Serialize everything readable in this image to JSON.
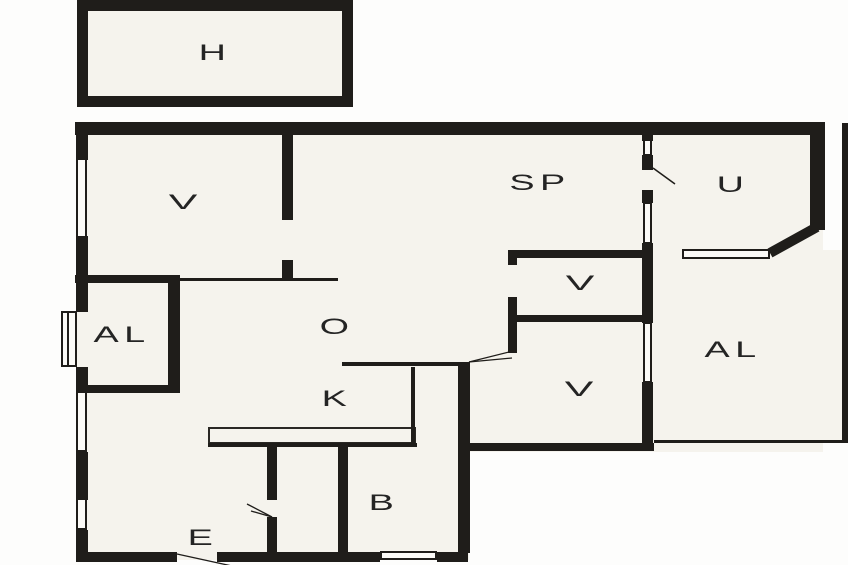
{
  "plan": {
    "width": 848,
    "height": 565,
    "colors": {
      "wall": "#1f1d1a",
      "interior": "#f5f3ed",
      "background": "#fdfdfc",
      "label": "#242424"
    },
    "rooms": [
      {
        "id": "garage",
        "label": "H",
        "x": 215,
        "y": 54,
        "wide": false
      },
      {
        "id": "bedroom-nw",
        "label": "V",
        "x": 183,
        "y": 203,
        "wide": true
      },
      {
        "id": "dining",
        "label": "SP",
        "x": 540,
        "y": 184,
        "wide": false
      },
      {
        "id": "utility",
        "label": "U",
        "x": 733,
        "y": 186,
        "wide": false
      },
      {
        "id": "alcove-west",
        "label": "AL",
        "x": 122,
        "y": 336,
        "wide": false
      },
      {
        "id": "living",
        "label": "O",
        "x": 337,
        "y": 328,
        "wide": false
      },
      {
        "id": "room-v-upper",
        "label": "V",
        "x": 580,
        "y": 284,
        "wide": true
      },
      {
        "id": "room-v-lower",
        "label": "V",
        "x": 579,
        "y": 390,
        "wide": true
      },
      {
        "id": "alcove-east",
        "label": "AL",
        "x": 733,
        "y": 351,
        "wide": false
      },
      {
        "id": "kitchen",
        "label": "K",
        "x": 337,
        "y": 400,
        "wide": false
      },
      {
        "id": "bathroom",
        "label": "B",
        "x": 384,
        "y": 504,
        "wide": false
      },
      {
        "id": "entrance",
        "label": "E",
        "x": 203,
        "y": 539,
        "wide": false
      }
    ],
    "fills": [
      [
        78,
        2,
        273,
        103
      ],
      [
        77,
        123,
        746,
        329
      ],
      [
        654,
        250,
        194,
        192
      ],
      [
        77,
        445,
        392,
        115
      ]
    ],
    "walls": [
      [
        77,
        0,
        276,
        11
      ],
      [
        77,
        96,
        276,
        11
      ],
      [
        77,
        0,
        11,
        107
      ],
      [
        342,
        0,
        11,
        107
      ],
      [
        75,
        122,
        750,
        13
      ],
      [
        76,
        122,
        12,
        38
      ],
      [
        76,
        236,
        12,
        76
      ],
      [
        76,
        367,
        12,
        26
      ],
      [
        76,
        452,
        12,
        48
      ],
      [
        76,
        530,
        12,
        32
      ],
      [
        76,
        552,
        101,
        10
      ],
      [
        217,
        552,
        163,
        10
      ],
      [
        437,
        552,
        31,
        10
      ],
      [
        810,
        122,
        15,
        108
      ],
      [
        842,
        123,
        6,
        320
      ],
      [
        282,
        122,
        11,
        98
      ],
      [
        282,
        260,
        11,
        18
      ],
      [
        75,
        275,
        105,
        8
      ],
      [
        168,
        275,
        12,
        117
      ],
      [
        83,
        385,
        97,
        8
      ],
      [
        642,
        135,
        11,
        6
      ],
      [
        642,
        155,
        11,
        15
      ],
      [
        642,
        190,
        11,
        13
      ],
      [
        642,
        243,
        11,
        80
      ],
      [
        642,
        382,
        11,
        68
      ],
      [
        508,
        250,
        145,
        8
      ],
      [
        508,
        250,
        9,
        15
      ],
      [
        517,
        315,
        136,
        7
      ],
      [
        508,
        297,
        9,
        56
      ],
      [
        458,
        362,
        12,
        191
      ],
      [
        267,
        445,
        10,
        55
      ],
      [
        267,
        517,
        10,
        36
      ],
      [
        338,
        445,
        10,
        108
      ],
      [
        470,
        443,
        184,
        8
      ]
    ],
    "thin_walls": [
      [
        180,
        278,
        158,
        3
      ],
      [
        342,
        362,
        126,
        4
      ],
      [
        411,
        367,
        4,
        76
      ],
      [
        208,
        443,
        209,
        4
      ],
      [
        654,
        440,
        194,
        3
      ],
      [
        67,
        313,
        2,
        53
      ]
    ],
    "windows": [
      [
        76,
        158,
        11,
        80
      ],
      [
        76,
        391,
        11,
        61
      ],
      [
        76,
        498,
        11,
        32
      ],
      [
        61,
        311,
        16,
        56
      ],
      [
        643,
        139,
        9,
        17
      ],
      [
        643,
        202,
        9,
        42
      ],
      [
        643,
        322,
        9,
        61
      ],
      [
        682,
        249,
        88,
        10
      ],
      [
        380,
        551,
        57,
        9
      ]
    ],
    "counter": [
      208,
      427,
      208,
      17
    ],
    "diagonal_walls": [
      [
        817,
        227,
        770,
        253,
        10
      ]
    ],
    "door_swings": [
      [
        653,
        168,
        675,
        184,
        1.5
      ],
      [
        469,
        362,
        513,
        351,
        1.3
      ],
      [
        469,
        362,
        512,
        358,
        1.3
      ],
      [
        272,
        517,
        247,
        504,
        1.3
      ],
      [
        272,
        517,
        251,
        511,
        1.3
      ],
      [
        177,
        554,
        232,
        566,
        1.3
      ]
    ]
  }
}
